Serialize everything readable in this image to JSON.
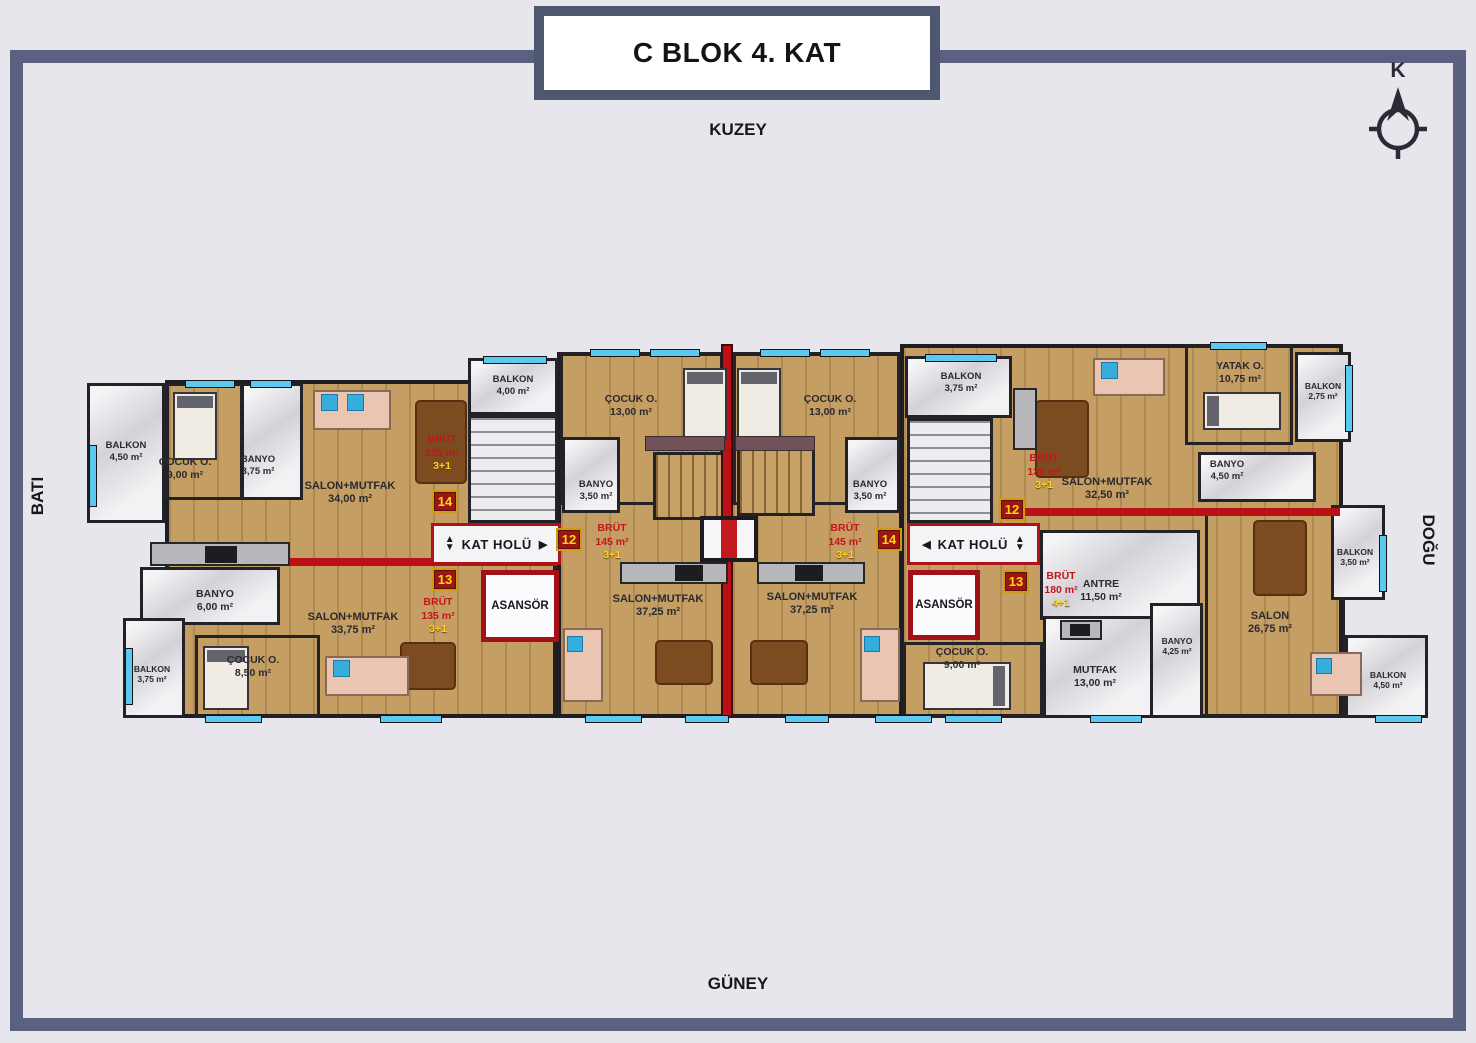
{
  "title": "C BLOK 4. KAT",
  "compass_letter": "K",
  "directions": {
    "north": "KUZEY",
    "south": "GÜNEY",
    "west": "BATI",
    "east": "DOĞU"
  },
  "core": {
    "hall": "KAT HOLÜ",
    "elevator": "ASANSÖR",
    "arrows": {
      "up": "▲",
      "down": "▼",
      "left": "◀",
      "right": "▶"
    }
  },
  "units": {
    "left_top": {
      "no": "14",
      "brut_label": "BRÜT",
      "brut_area": "135 m²",
      "plan": "3+1"
    },
    "left_bottom": {
      "no": "13",
      "brut_label": "BRÜT",
      "brut_area": "135 m²",
      "plan": "3+1"
    },
    "center_left": {
      "no": "12",
      "brut_label": "BRÜT",
      "brut_area": "145 m²",
      "plan": "3+1"
    },
    "center_right": {
      "no": "14",
      "brut_label": "BRÜT",
      "brut_area": "145 m²",
      "plan": "3+1"
    },
    "right_top": {
      "no": "12",
      "brut_label": "BRÜT",
      "brut_area": "130 m²",
      "plan": "3+1"
    },
    "right_bottom": {
      "no": "13",
      "brut_label": "BRÜT",
      "brut_area": "180 m²",
      "plan": "4+1"
    }
  },
  "rooms": {
    "balkonL45": {
      "name": "BALKON",
      "area": "4,50 m²"
    },
    "cocukL9": {
      "name": "ÇOCUK O.",
      "area": "9,00 m²"
    },
    "banyoL375": {
      "name": "BANYO",
      "area": "3,75 m²"
    },
    "salon34": {
      "name": "SALON+MUTFAK",
      "area": "34,00 m²"
    },
    "banyo6": {
      "name": "BANYO",
      "area": "6,00 m²"
    },
    "cocuk85": {
      "name": "ÇOCUK O.",
      "area": "8,50 m²"
    },
    "balkonL375": {
      "name": "BALKON",
      "area": "3,75 m²"
    },
    "salon3375": {
      "name": "SALON+MUTFAK",
      "area": "33,75 m²"
    },
    "balkonCore4": {
      "name": "BALKON",
      "area": "4,00 m²"
    },
    "cocukCL13": {
      "name": "ÇOCUK O.",
      "area": "13,00 m²"
    },
    "banyoCL35": {
      "name": "BANYO",
      "area": "3,50 m²"
    },
    "salonCL3725": {
      "name": "SALON+MUTFAK",
      "area": "37,25 m²"
    },
    "cocukCR13": {
      "name": "ÇOCUK O.",
      "area": "13,00 m²"
    },
    "banyoCR35": {
      "name": "BANYO",
      "area": "3,50 m²"
    },
    "salonCR3725": {
      "name": "SALON+MUTFAK",
      "area": "37,25 m²"
    },
    "balkonCoreR375": {
      "name": "BALKON",
      "area": "3,75 m²"
    },
    "salon325": {
      "name": "SALON+MUTFAK",
      "area": "32,50 m²"
    },
    "yatak1075": {
      "name": "YATAK O.",
      "area": "10,75 m²"
    },
    "balkonR275": {
      "name": "BALKON",
      "area": "2,75 m²"
    },
    "banyoR45": {
      "name": "BANYO",
      "area": "4,50 m²"
    },
    "antre115": {
      "name": "ANTRE",
      "area": "11,50 m²"
    },
    "cocukR9": {
      "name": "ÇOCUK O.",
      "area": "9,00 m²"
    },
    "mutfak13": {
      "name": "MUTFAK",
      "area": "13,00 m²"
    },
    "banyoR425": {
      "name": "BANYO",
      "area": "4,25 m²"
    },
    "salon2675": {
      "name": "SALON",
      "area": "26,75 m²"
    },
    "balkonR35": {
      "name": "BALKON",
      "area": "3,50 m²"
    },
    "balkonR45": {
      "name": "BALKON",
      "area": "4,50 m²"
    }
  }
}
